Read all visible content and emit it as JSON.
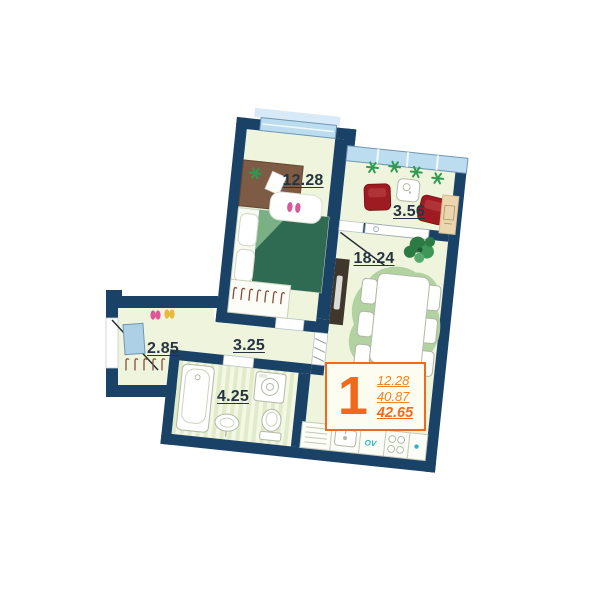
{
  "apartment_plan": {
    "summary_badge": {
      "rooms_count": "1",
      "area_line1": "12.28",
      "area_line2": "40.87",
      "area_line3": "42.65"
    },
    "room_labels": {
      "bedroom": "12.28",
      "loggia": "3.56",
      "living_kitchen": "18.24",
      "hallway": "3.25",
      "bathroom": "4.25",
      "entry": "2.85"
    },
    "kitchen_unit_text": "OV"
  },
  "colors": {
    "wall": "#1a4266",
    "floor": "#eef5dc",
    "accent_orange": "#f2691c",
    "window_glass": "#bcdcf0",
    "living_rug_green": "#b2d2a2",
    "armchair_red": "#9e1c21",
    "bed_blanket_green": "#2e6b52",
    "label_text": "#273340"
  }
}
